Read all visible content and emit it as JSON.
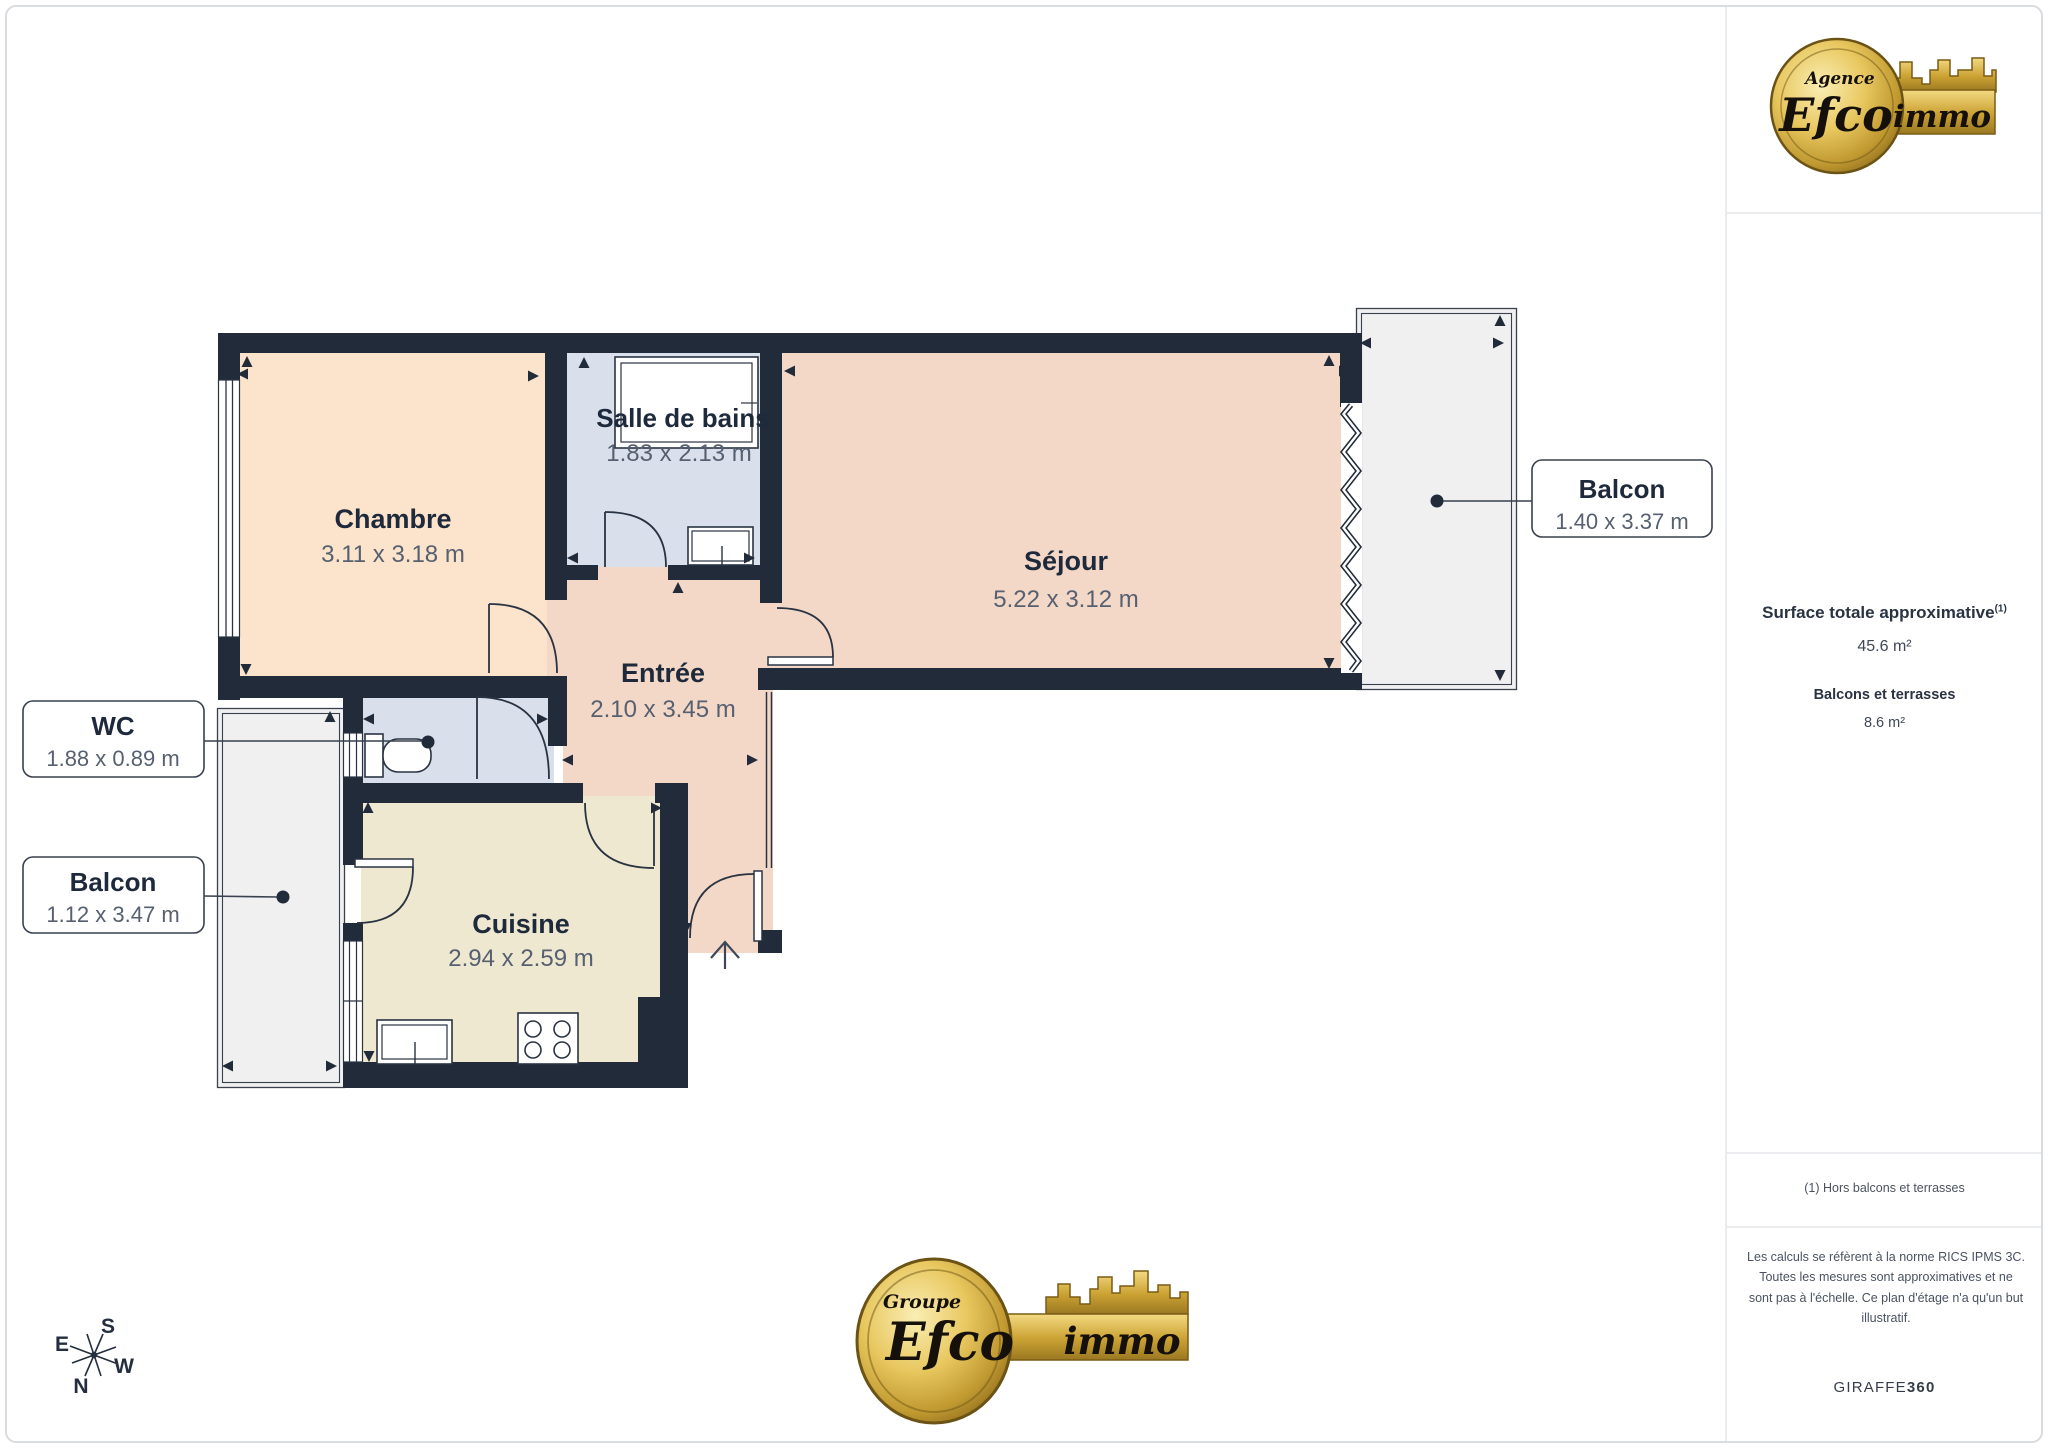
{
  "header_logo": {
    "top_label": "Agence",
    "brand": "Efco",
    "brand_suffix": "immo"
  },
  "footer_logo": {
    "top_label": "Groupe",
    "brand": "Efco",
    "brand_suffix": "immo"
  },
  "rooms": {
    "chambre": {
      "name": "Chambre",
      "dims": "3.11 x 3.18 m"
    },
    "salle_de_bains": {
      "name": "Salle de bains",
      "dims": "1.83 x 2.13 m"
    },
    "sejour": {
      "name": "Séjour",
      "dims": "5.22 x 3.12 m"
    },
    "entree": {
      "name": "Entrée",
      "dims": "2.10 x 3.45 m"
    },
    "wc": {
      "name": "WC",
      "dims": "1.88 x 0.89 m"
    },
    "cuisine": {
      "name": "Cuisine",
      "dims": "2.94 x 2.59 m"
    },
    "balcon_droit": {
      "name": "Balcon",
      "dims": "1.40 x 3.37 m"
    },
    "balcon_gauche": {
      "name": "Balcon",
      "dims": "1.12 x 3.47 m"
    }
  },
  "sidebar": {
    "surface_title": "Surface totale approximative",
    "surface_note_ref": "(1)",
    "surface_value": "45.6 m²",
    "balcony_title": "Balcons et terrasses",
    "balcony_value": "8.6 m²",
    "footnote": "(1) Hors balcons et terrasses",
    "disclaimer": "Les calculs se réfèrent à la norme RICS IPMS 3C. Toutes les mesures sont approximatives et ne sont pas à l'échelle. Ce plan d'étage n'a qu'un but illustratif.",
    "credit_brand": "GIRAFFE",
    "credit_brand_bold": "360"
  },
  "compass": {
    "n": "N",
    "s": "S",
    "e": "E",
    "w": "W"
  },
  "colors": {
    "wall": "#212b3a",
    "bedroom_fill": "#fbe4cb",
    "bathroom_fill": "#d9e0ec",
    "living_fill": "#f3d8c8",
    "kitchen_fill": "#efe8d1",
    "balcony_fill": "#f0f0f1",
    "brand_gold": "#d4af4e",
    "label_text": "#1e2a3c",
    "dim_text": "#566070"
  }
}
